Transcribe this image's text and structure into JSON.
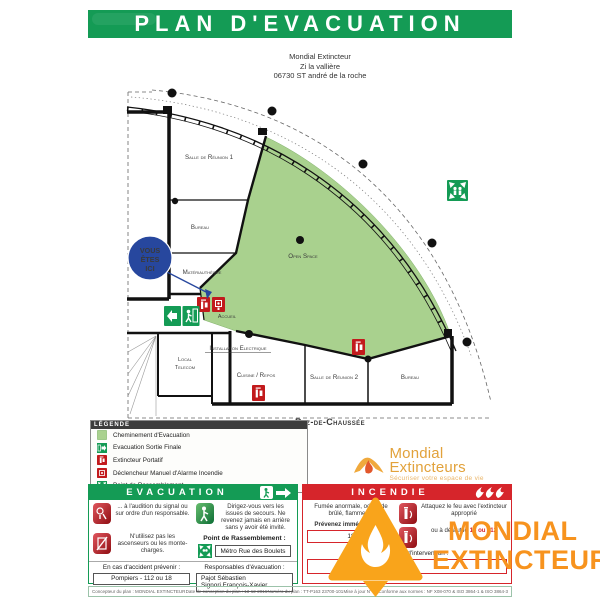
{
  "header": {
    "title": "PLAN D'EVACUATION"
  },
  "address": {
    "lines": [
      "Mondial Extincteur",
      "Zi la vallière",
      "06730 ST andré de la roche"
    ]
  },
  "plan": {
    "floor_label": "Rez-de-Chaussée",
    "you_are_here": {
      "line1": "VOUS",
      "line2": "ÊTES",
      "line3": "ICI"
    },
    "rooms": {
      "salle_reunion_1": "Salle de Réunion 1",
      "bureau_1": "Bureau",
      "materiautheque": "Matériauthèque",
      "accueil": "Accueil",
      "open_space": "Open Space",
      "local_telecom_1": "Local",
      "local_telecom_2": "Telecom",
      "installation_electrique": "Installation Electrique",
      "cuisine_repos": "Cuisine / Repos",
      "salle_reunion_2": "Salle de Réunion 2",
      "bureau_2": "Bureau"
    }
  },
  "legend": {
    "title": "LÉGENDE",
    "items": [
      {
        "icon": "evacuation-path-swatch",
        "label": "Cheminement d'Evacuation"
      },
      {
        "icon": "final-exit-icon",
        "label": "Evacuation Sortie Finale"
      },
      {
        "icon": "extinguisher-icon",
        "label": "Extincteur Portatif"
      },
      {
        "icon": "manual-alarm-icon",
        "label": "Déclencheur Manuel d'Alarme Incendie"
      },
      {
        "icon": "assembly-point-icon",
        "label": "Point de Rassemblement"
      }
    ]
  },
  "brand": {
    "name": "Mondial Extincteurs",
    "tagline": "Sécuriser votre espace de vie"
  },
  "evacuation": {
    "title": "EVACUATION",
    "step_signal": "... à l'audition du signal ou sur ordre d'un responsable.",
    "step_exits": "Dirigez-vous vers les issues de secours. Ne revenez jamais en arrière sans y avoir été invité.",
    "step_elevators": "N'utilisez pas les ascenseurs ou les monte-charges.",
    "assembly_label": "Point de Rassemblement :",
    "assembly_value": "Métro Rue des Boulets",
    "accident_label": "En cas d'accident prévenir :",
    "accident_value": "Pompiers - 112 ou 18",
    "responsables_label": "Responsables d'évacuation :",
    "responsable_1": "Pajot Sébastien",
    "responsable_2": "Signori François-Xavier"
  },
  "incendie": {
    "title": "INCENDIE",
    "smoke_text": "Fumée anormale, odeur de brûlé, flammes ?",
    "warn_label": "Prévenez immédiatement",
    "warn_value": "18",
    "attack_text": "Attaquez le feu avec l'extincteur approprié",
    "fallback_text": "ou à défaut le",
    "fallback_numbers": "18 ou 112",
    "intervention_label": "Responsables d'intervention :"
  },
  "watermark": {
    "line1": "MONDIAL",
    "line2": "EXTINCTEUR"
  },
  "footer": {
    "designer": "Concepteur du plan : MONDIAL EXTINCTEUR",
    "date": "Date de conception du plan : 13-12-2016",
    "number": "Numéro du plan : TT-P163 23700-101",
    "revision": "Mise à jour N° : 1",
    "norms": "Conforme aux normes : NF X08-070 & ISO 3864-1 & ISO 3864-3"
  },
  "colors": {
    "header_green": "#149b55",
    "evacuation_path_green": "#a9d18e",
    "incendie_red": "#d6252b",
    "safety_red": "#c21a1c",
    "brand_orange": "#f7931e",
    "brand_gold": "#e2a23b",
    "you_are_here_blue": "#27479e"
  }
}
